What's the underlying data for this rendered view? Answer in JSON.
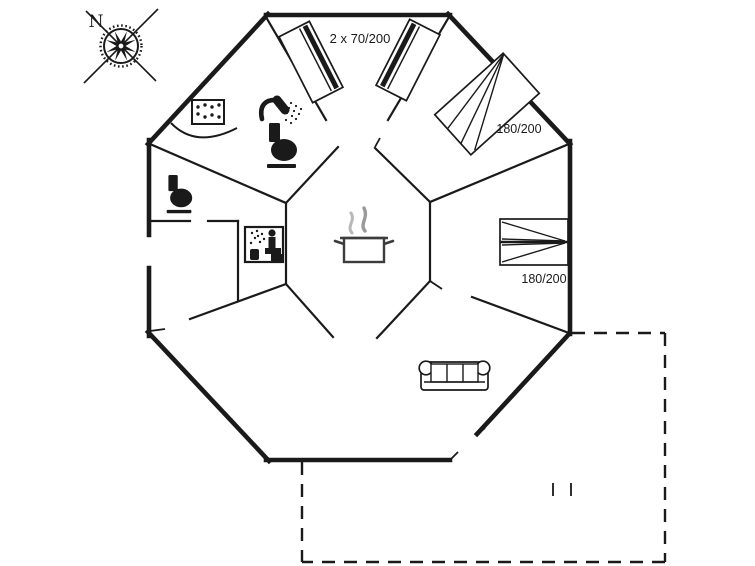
{
  "plan": {
    "compass_label": "N",
    "bed_labels": {
      "top_bedroom": "2 x 70/200",
      "upper_right_bedroom": "180/200",
      "right_bedroom": "180/200"
    },
    "colors": {
      "wall": "#1a1a1a",
      "background": "#ffffff",
      "steam_light": "#b8b8b8",
      "steam_dark": "#9a9a9a",
      "pot_outline": "#3c3c3c"
    },
    "icons": [
      "compass-rose-icon",
      "corner-bath-icon",
      "shower-icon",
      "toilet-icon",
      "sauna-icon",
      "cooking-pot-icon",
      "sofa-icon",
      "single-bed-icon",
      "double-bed-icon"
    ]
  }
}
